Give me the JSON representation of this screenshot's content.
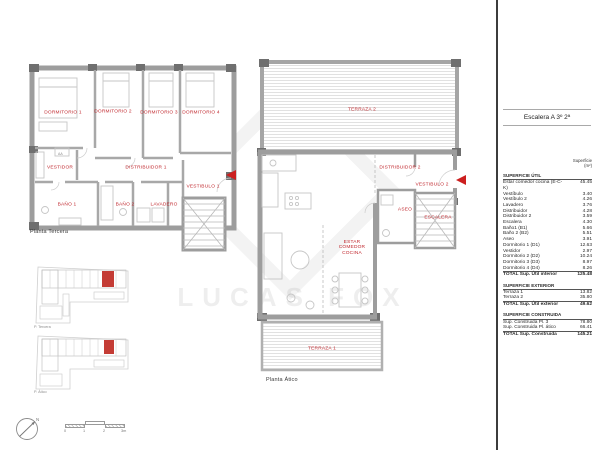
{
  "titleblock": {
    "title": "Escalera A 3º 2ª"
  },
  "plans": {
    "tercera": {
      "caption": "Planta Tercera",
      "ac_label": "AA",
      "rooms": {
        "dormitorio1": "DORMITORIO 1",
        "dormitorio2": "DORMITORIO 2",
        "dormitorio3": "DORMITORIO 3",
        "dormitorio4": "DORMITORIO 4",
        "vestidor": "VESTIDOR",
        "distribuidor1": "DISTRIBUIDOR 1",
        "vestibulo1": "VESTIBULO 1",
        "bano1": "BAÑO 1",
        "bano2": "BAÑO 2",
        "lavadero": "LAVADERO"
      }
    },
    "atico": {
      "caption": "Planta Ático",
      "rooms": {
        "terraza2": "TERRAZA 2",
        "distribuidor2": "DISTRIBUIDOR 2",
        "vestibulo2": "VESTIBULO 2",
        "estar": "ESTAR COMEDOR COCINA",
        "aseo": "ASEO",
        "escalera": "ESCALERA",
        "terraza1": "TERRAZA 1"
      }
    }
  },
  "keyplans": {
    "tercera_caption": "P. Tercera",
    "atico_caption": "P. Ático"
  },
  "panel": {
    "header_line1": "Superficie",
    "header_line2": "(m²)",
    "rows": [
      {
        "type": "section",
        "label": "SUPERFICIE ÚTIL",
        "value": ""
      },
      {
        "type": "item",
        "label": "Estar comedor cocina (E-C-K)",
        "value": "45.45"
      },
      {
        "type": "item",
        "label": "Vestíbulo",
        "value": "3.40"
      },
      {
        "type": "item",
        "label": "Vestíbulo 2",
        "value": "4.26"
      },
      {
        "type": "item",
        "label": "Lavadero",
        "value": "3.76"
      },
      {
        "type": "item",
        "label": "Distribuidor",
        "value": "4.28"
      },
      {
        "type": "item",
        "label": "Distribuidor 2",
        "value": "3.59"
      },
      {
        "type": "item",
        "label": "Escalera",
        "value": "4.30"
      },
      {
        "type": "item",
        "label": "Baño1 (B1)",
        "value": "5.66"
      },
      {
        "type": "item",
        "label": "Baño 2 (B2)",
        "value": "5.51"
      },
      {
        "type": "item",
        "label": "Aseo",
        "value": "3.91"
      },
      {
        "type": "item",
        "label": "Dormitorio 1 (D1)",
        "value": "12.63"
      },
      {
        "type": "item",
        "label": "Vestidor",
        "value": "2.97"
      },
      {
        "type": "item",
        "label": "Dormitorio 2 (D2)",
        "value": "10.24"
      },
      {
        "type": "item",
        "label": "Dormitorio 3 (D3)",
        "value": "8.97"
      },
      {
        "type": "item",
        "label": "Dormitorio 4 (D4)",
        "value": "8.26"
      },
      {
        "type": "total",
        "label": "TOTAL Sup. Útil interior",
        "value": "125.48"
      },
      {
        "type": "section",
        "label": "SUPERFICIE EXTERIOR",
        "value": ""
      },
      {
        "type": "item",
        "label": "Terraza 1",
        "value": "13.82"
      },
      {
        "type": "item",
        "label": "Terraza 2",
        "value": "35.80"
      },
      {
        "type": "total",
        "label": "TOTAL Sup. Útil exterior",
        "value": "49.62"
      },
      {
        "type": "section",
        "label": "SUPERFICIE CONSTRUIDA",
        "value": ""
      },
      {
        "type": "item",
        "label": "Sup. Construida Pl. 3",
        "value": "78.80"
      },
      {
        "type": "item",
        "label": "Sup. Construida Pl. ático",
        "value": "66.41"
      },
      {
        "type": "total",
        "label": "TOTAL Sup. Construida",
        "value": "145.21"
      }
    ]
  },
  "scalebar": {
    "labels": [
      "0",
      "1",
      "2",
      "3m"
    ]
  },
  "compass": {
    "north_label": "N"
  },
  "watermark": {
    "text": "LUCAS FOX"
  },
  "colors": {
    "room_label": "#c0272d",
    "entry_arrow": "#cc1f1f",
    "wall": "#9d9d9d",
    "unit_highlight": "#c43c35",
    "divider": "#3c3c3c"
  }
}
